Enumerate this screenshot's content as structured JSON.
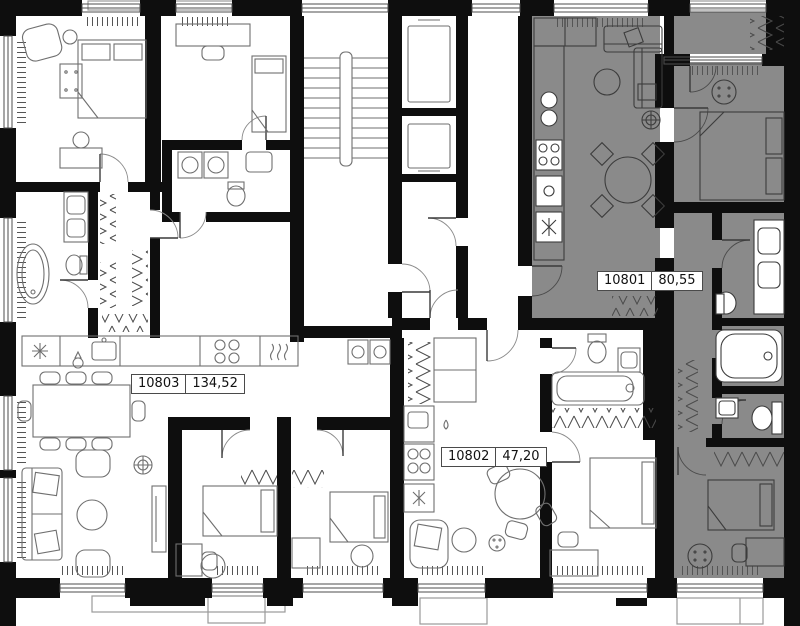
{
  "floorplan": {
    "units": [
      {
        "number": "10801",
        "area": "80,55",
        "highlighted": true
      },
      {
        "number": "10802",
        "area": "47,20",
        "highlighted": false
      },
      {
        "number": "10803",
        "area": "134,52",
        "highlighted": false
      }
    ],
    "colors": {
      "highlight_fill": "#8a8a8a",
      "wall": "#0e0e0e",
      "background": "#ffffff",
      "furniture_line": "#6f6f6f",
      "furniture_line_on_highlight": "#3c3c3c",
      "label_border": "#4a4a4a",
      "label_text": "#111111"
    }
  }
}
